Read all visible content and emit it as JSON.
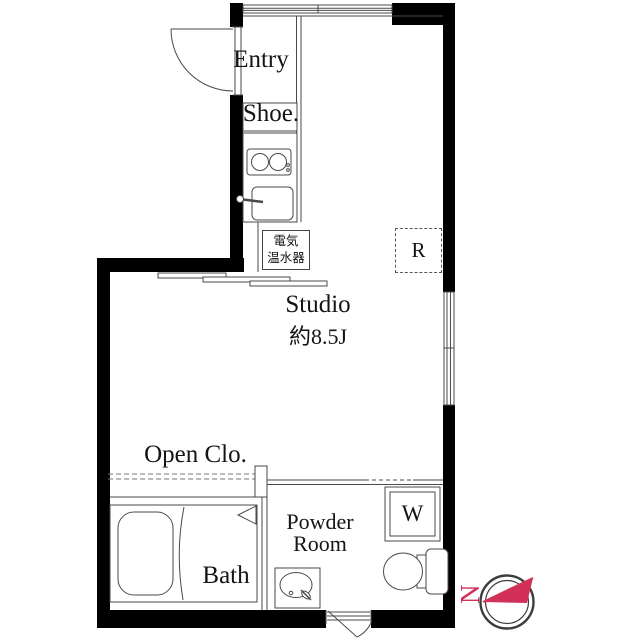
{
  "plan": {
    "rooms": {
      "entry": "Entry",
      "shoe": "Shoe.",
      "water_heater_line1": "電気",
      "water_heater_line2": "温水器",
      "refrigerator": "R",
      "studio_name": "Studio",
      "studio_area": "約8.5J",
      "open_closet": "Open Clo.",
      "bath": "Bath",
      "powder_line1": "Powder",
      "powder_line2": "Room",
      "washer": "W"
    },
    "compass": {
      "north": "N"
    },
    "colors": {
      "wall": "#000000",
      "line": "#4a4a4a",
      "accent": "#d23059"
    }
  }
}
